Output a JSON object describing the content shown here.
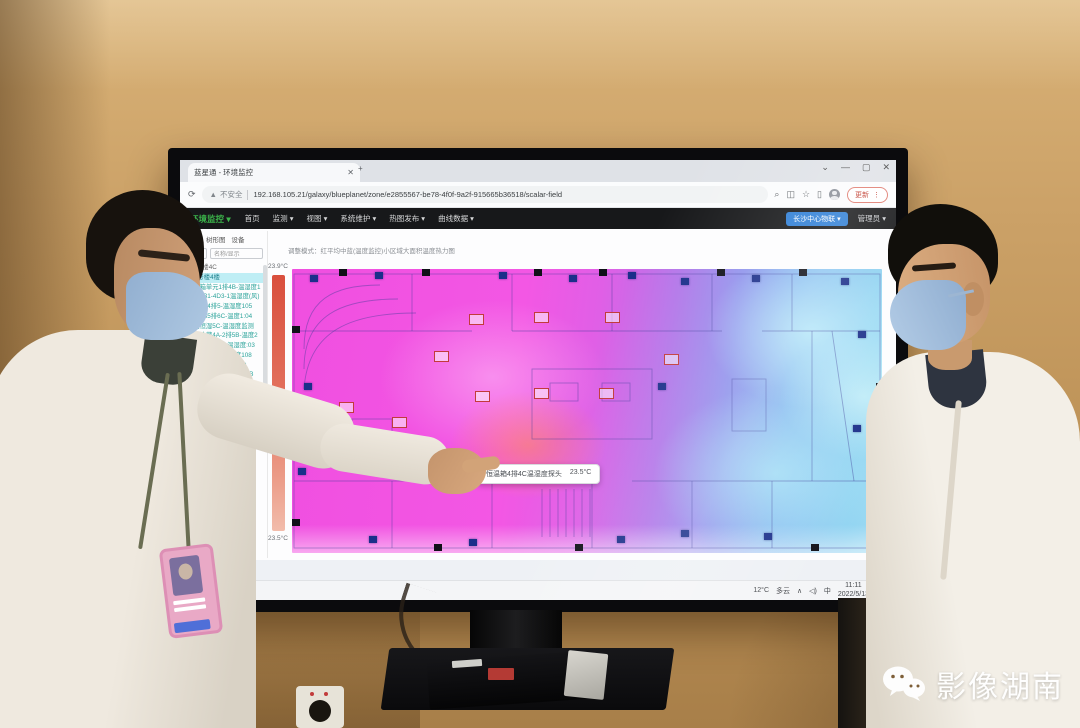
{
  "window": {
    "tab_title": "蓝星通 - 环境监控",
    "tab_close": "✕",
    "new_tab": "+",
    "controls": {
      "search": "⌄",
      "min": "—",
      "max": "▢",
      "close": "✕"
    },
    "refresh": "⟳",
    "security": "不安全",
    "warn_icon": "▲",
    "url": "192.168.105.21/galaxy/blueplanet/zone/e2855567-be78-4f0f-9a2f-915665b36518/scalar-field",
    "search_icon": "⌕",
    "star_icon": "☆",
    "panel_icon": "▯",
    "ext_icon": "◫",
    "update_button": "更新",
    "kebab": "⋮"
  },
  "navbar": {
    "brand": "环境监控 ▾",
    "menus": [
      "首页",
      "监测 ▾",
      "视图 ▾",
      "系统维护 ▾",
      "热图发布 ▾",
      "曲线数据 ▾"
    ],
    "site_button": "长沙中心物联 ▾",
    "user_menu": "管理员 ▾"
  },
  "sidebar": {
    "tabs": [
      "区域",
      "树形图",
      "设备"
    ],
    "select_caret": "▾",
    "filter_placeholder": "名称/显示",
    "items": [
      {
        "label": "1-4号楼4C",
        "muted": true
      },
      {
        "label": "区A号楼4楼",
        "active": true
      },
      {
        "label": "恒温箱单元1排4B-温湿度1"
      },
      {
        "label": "三洋4B1-4D3-1温湿度(风)"
      },
      {
        "label": "恒温4B4排5-温湿度105"
      },
      {
        "label": "恒湿4B5排6C-温度1:04"
      },
      {
        "label": "恒温恒湿5C-温湿度监测"
      },
      {
        "label": "药品冷藏4A-2排5B-温度2"
      },
      {
        "label": "恒温4B6排5C-温湿度:03"
      },
      {
        "label": "试剂库房4C-温湿度108"
      },
      {
        "label": "样本库4D-温湿度10C"
      },
      {
        "label": "低温冰箱-80℃-温度10B"
      },
      {
        "label": "培养箱4C-温湿度10B"
      }
    ]
  },
  "heatmap": {
    "header": "调整模式：红平均中蓝(温度监控)小区域大面积温度热力图",
    "scale_max": "23.9°C",
    "scale_min": "23.5°C",
    "tooltip": {
      "label": "恒温箱4排4C温湿度探头",
      "value": "23.5°C"
    },
    "sensors": [
      {
        "style": "left:3%;top:2%"
      },
      {
        "style": "left:14%;top:1%"
      },
      {
        "style": "left:35%;top:1%"
      },
      {
        "style": "left:47%;top:2%"
      },
      {
        "style": "left:57%;top:1%"
      },
      {
        "style": "left:66%;top:3%"
      },
      {
        "style": "left:78%;top:2%"
      },
      {
        "style": "left:93%;top:3%"
      },
      {
        "style": "left:96%;top:22%"
      },
      {
        "style": "left:95%;top:55%"
      },
      {
        "style": "left:62%;top:40%"
      },
      {
        "style": "left:2%;top:40%"
      },
      {
        "style": "left:1%;top:70%"
      },
      {
        "style": "left:30%;top:95%"
      },
      {
        "style": "left:55%;top:94%"
      },
      {
        "style": "left:80%;top:93%"
      },
      {
        "style": "left:13%;top:94%"
      },
      {
        "style": "left:66%;top:92%"
      }
    ],
    "pillars": [
      {
        "style": "left:8%;top:0%"
      },
      {
        "style": "left:22%;top:0%"
      },
      {
        "style": "left:41%;top:0%"
      },
      {
        "style": "left:52%;top:0%"
      },
      {
        "style": "left:72%;top:0%"
      },
      {
        "style": "left:86%;top:0%"
      },
      {
        "style": "left:0%;top:20%"
      },
      {
        "style": "left:0%;top:88%"
      },
      {
        "style": "left:24%;top:97%"
      },
      {
        "style": "left:48%;top:97%"
      },
      {
        "style": "left:88%;top:97%"
      },
      {
        "style": "left:99%;top:40%"
      }
    ],
    "labels": [
      {
        "style": "left:30%;top:16%"
      },
      {
        "style": "left:41%;top:15%"
      },
      {
        "style": "left:53%;top:15%"
      },
      {
        "style": "left:24%;top:29%"
      },
      {
        "style": "left:31%;top:43%"
      },
      {
        "style": "left:41%;top:42%"
      },
      {
        "style": "left:52%;top:42%"
      },
      {
        "style": "left:17%;top:52%"
      },
      {
        "style": "left:8%;top:47%"
      },
      {
        "style": "left:63%;top:30%"
      }
    ]
  },
  "taskbar": {
    "weather_temp": "12°C",
    "weather_desc": "多云",
    "chevron": "∧",
    "volume": "◁)",
    "ime": "中",
    "time": "11:11",
    "date": "2022/5/13",
    "tray_badge": "1"
  },
  "watermark": {
    "text": "影像湖南"
  },
  "colors": {
    "brand_green": "#3cb54b",
    "site_pill_blue": "#2f7fd6",
    "sidebar_active": "#bfeef5",
    "heat_hot_magenta": "#f152e2",
    "heat_cool_cyan": "#8fd2f1",
    "scale_top_red": "#d94f3d",
    "update_red": "#c0392b"
  }
}
